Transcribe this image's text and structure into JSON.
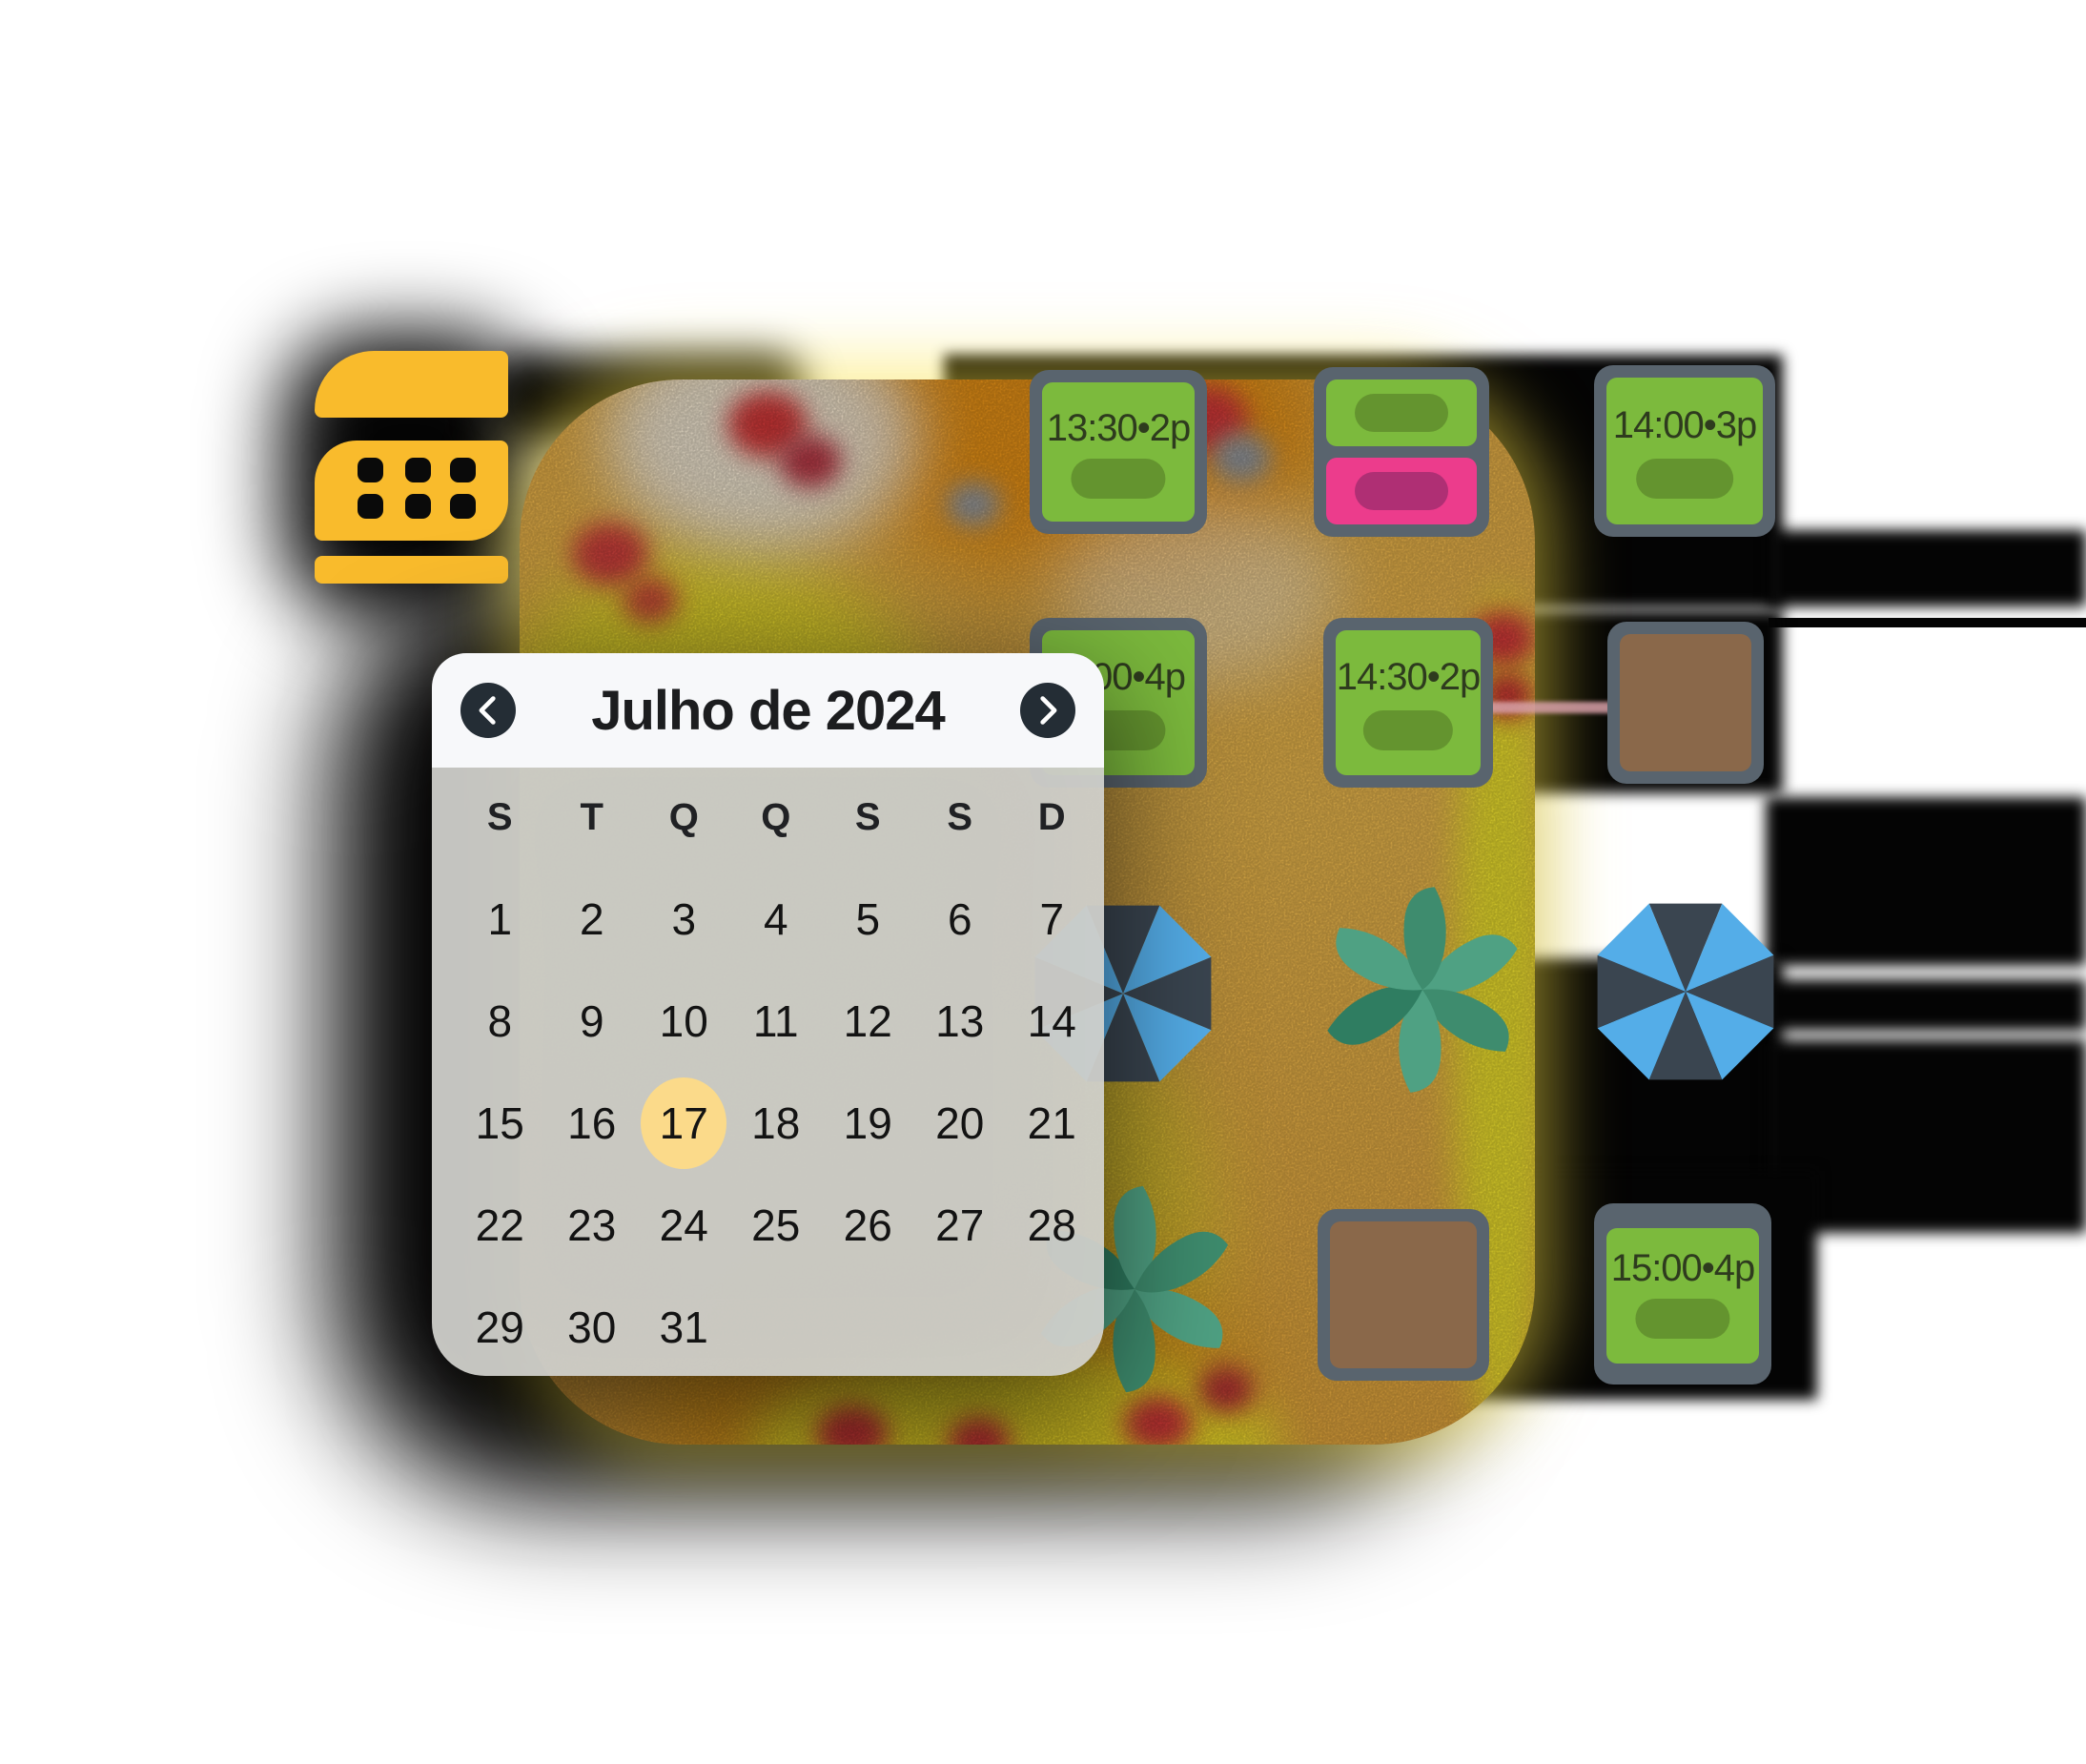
{
  "app": {
    "background": "#ffffff"
  },
  "logo": {
    "name": "calendar-logo",
    "color": "#F9BB2C"
  },
  "calendar": {
    "title": "Julho de 2024",
    "prev_icon": "chevron-left",
    "next_icon": "chevron-right",
    "weekdays": [
      "S",
      "T",
      "Q",
      "Q",
      "S",
      "S",
      "D"
    ],
    "days": [
      "1",
      "2",
      "3",
      "4",
      "5",
      "6",
      "7",
      "8",
      "9",
      "10",
      "11",
      "12",
      "13",
      "14",
      "15",
      "16",
      "17",
      "18",
      "19",
      "20",
      "21",
      "22",
      "23",
      "24",
      "25",
      "26",
      "27",
      "28",
      "29",
      "30",
      "31"
    ],
    "selected_day": "17",
    "selected_color": "#FBDA8A",
    "header_bg": "#F7F8FA",
    "body_bg": "rgba(211,211,207,0.93)",
    "nav_circle_color": "#242D35"
  },
  "reservations": {
    "cards": [
      {
        "label": "13:30•2p",
        "type": "green"
      },
      {
        "label": "",
        "type": "green-pink-split"
      },
      {
        "label": "14:00•3p",
        "type": "green"
      },
      {
        "label": "00•4p",
        "type": "green-clipped"
      },
      {
        "label": "14:30•2p",
        "type": "green"
      },
      {
        "label": "15:00•4p",
        "type": "green"
      }
    ],
    "tables_empty": 2,
    "colors": {
      "green": "#7CBA3D",
      "green_pill": "#64942F",
      "pink": "#EC3C8C",
      "pink_pill": "#AF2F74",
      "frame": "#59646E",
      "table_brown": "#8A684A",
      "label_text": "#2E3B1E"
    }
  },
  "map_objects": {
    "umbrella_dark": "#3A4550",
    "umbrella_blue": "#54ADE8",
    "plant_leaf_light": "#4FA183",
    "plant_leaf_dark": "#3E8C6E",
    "heatmap_base": "#F3B84A",
    "heatmap_hot_yellow": "#F9F02C",
    "heatmap_orange": "#F2930F",
    "heatmap_spot_red": "#DF3B3B"
  }
}
